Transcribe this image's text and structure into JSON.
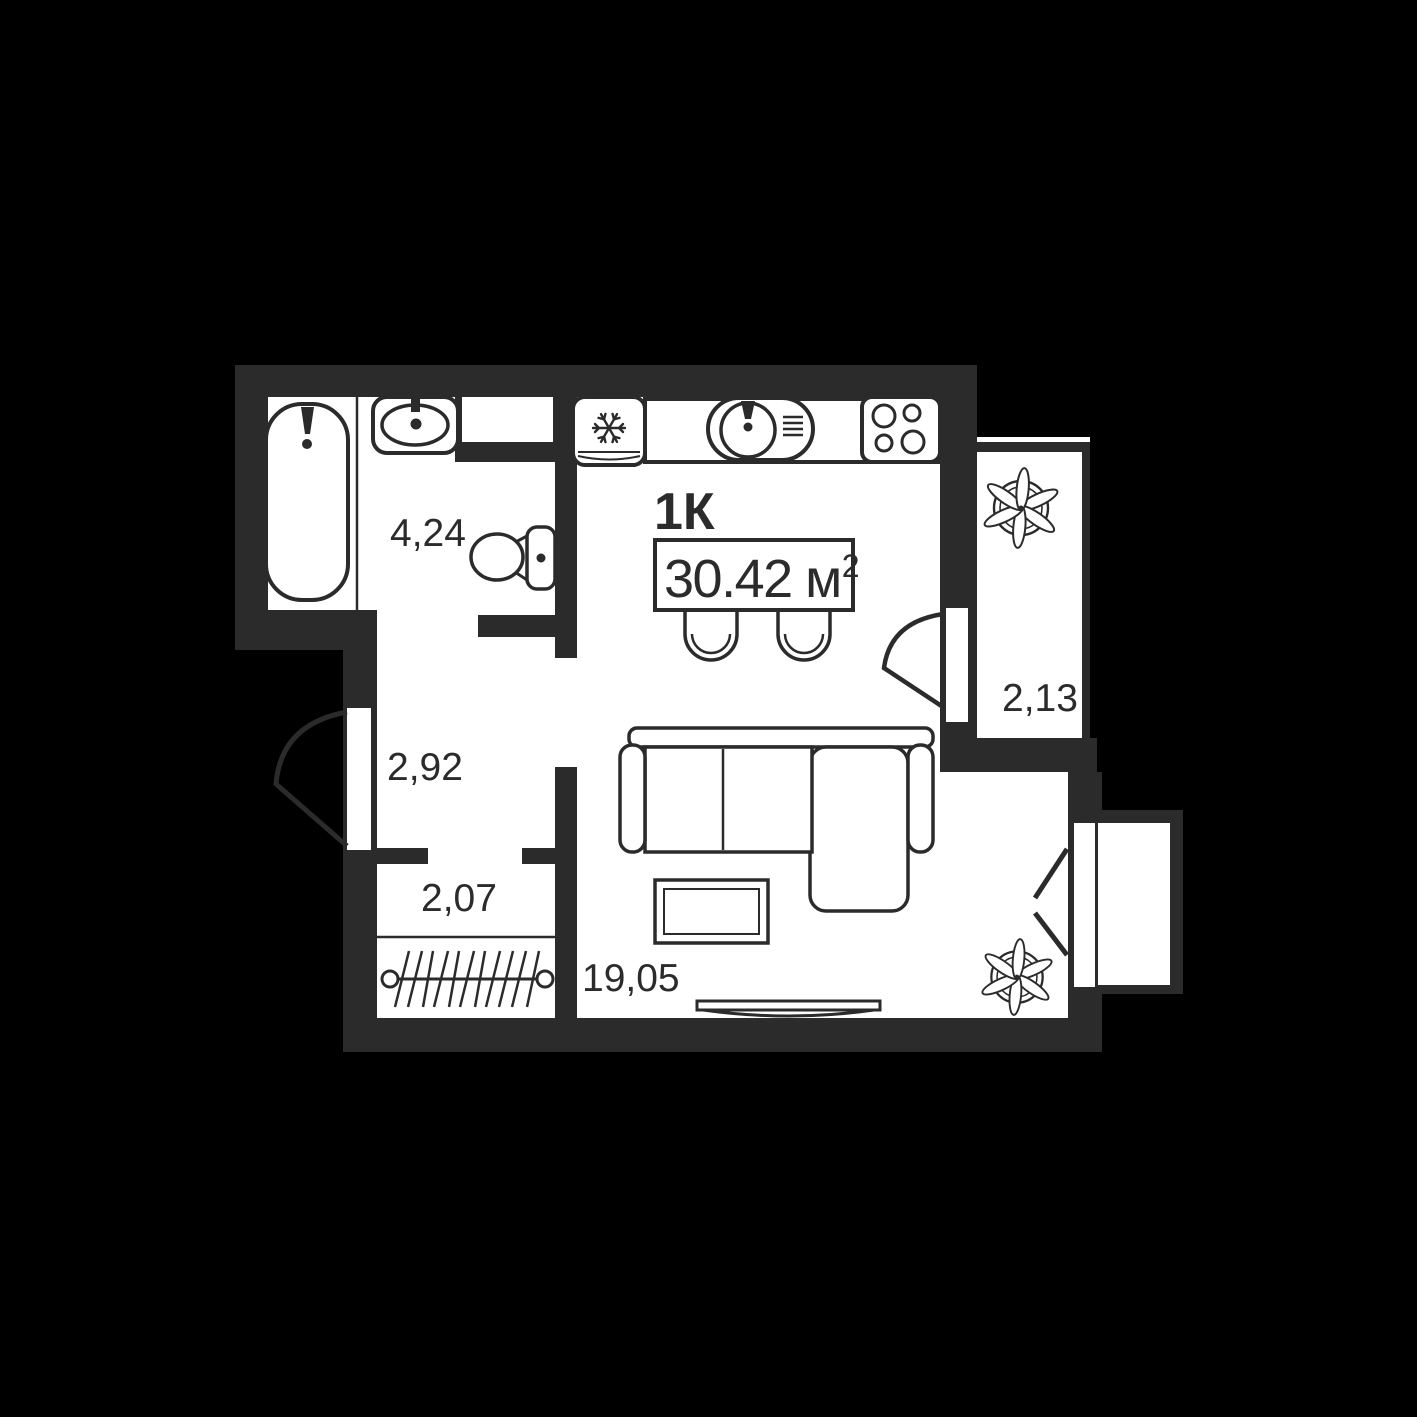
{
  "colors": {
    "background": "#000000",
    "wall": "#2b2b2b",
    "line": "#2b2b2b",
    "floor": "#ffffff"
  },
  "plan": {
    "type_label": "1К",
    "total_area": {
      "value": "30.42",
      "unit": "м",
      "superscript": "2"
    },
    "rooms": [
      {
        "id": "bathroom",
        "area": "4,24"
      },
      {
        "id": "hallway",
        "area": "2,92"
      },
      {
        "id": "wardrobe",
        "area": "2,07"
      },
      {
        "id": "living-kitchen",
        "area": "19,05"
      },
      {
        "id": "balcony",
        "area": "2,13"
      }
    ]
  }
}
